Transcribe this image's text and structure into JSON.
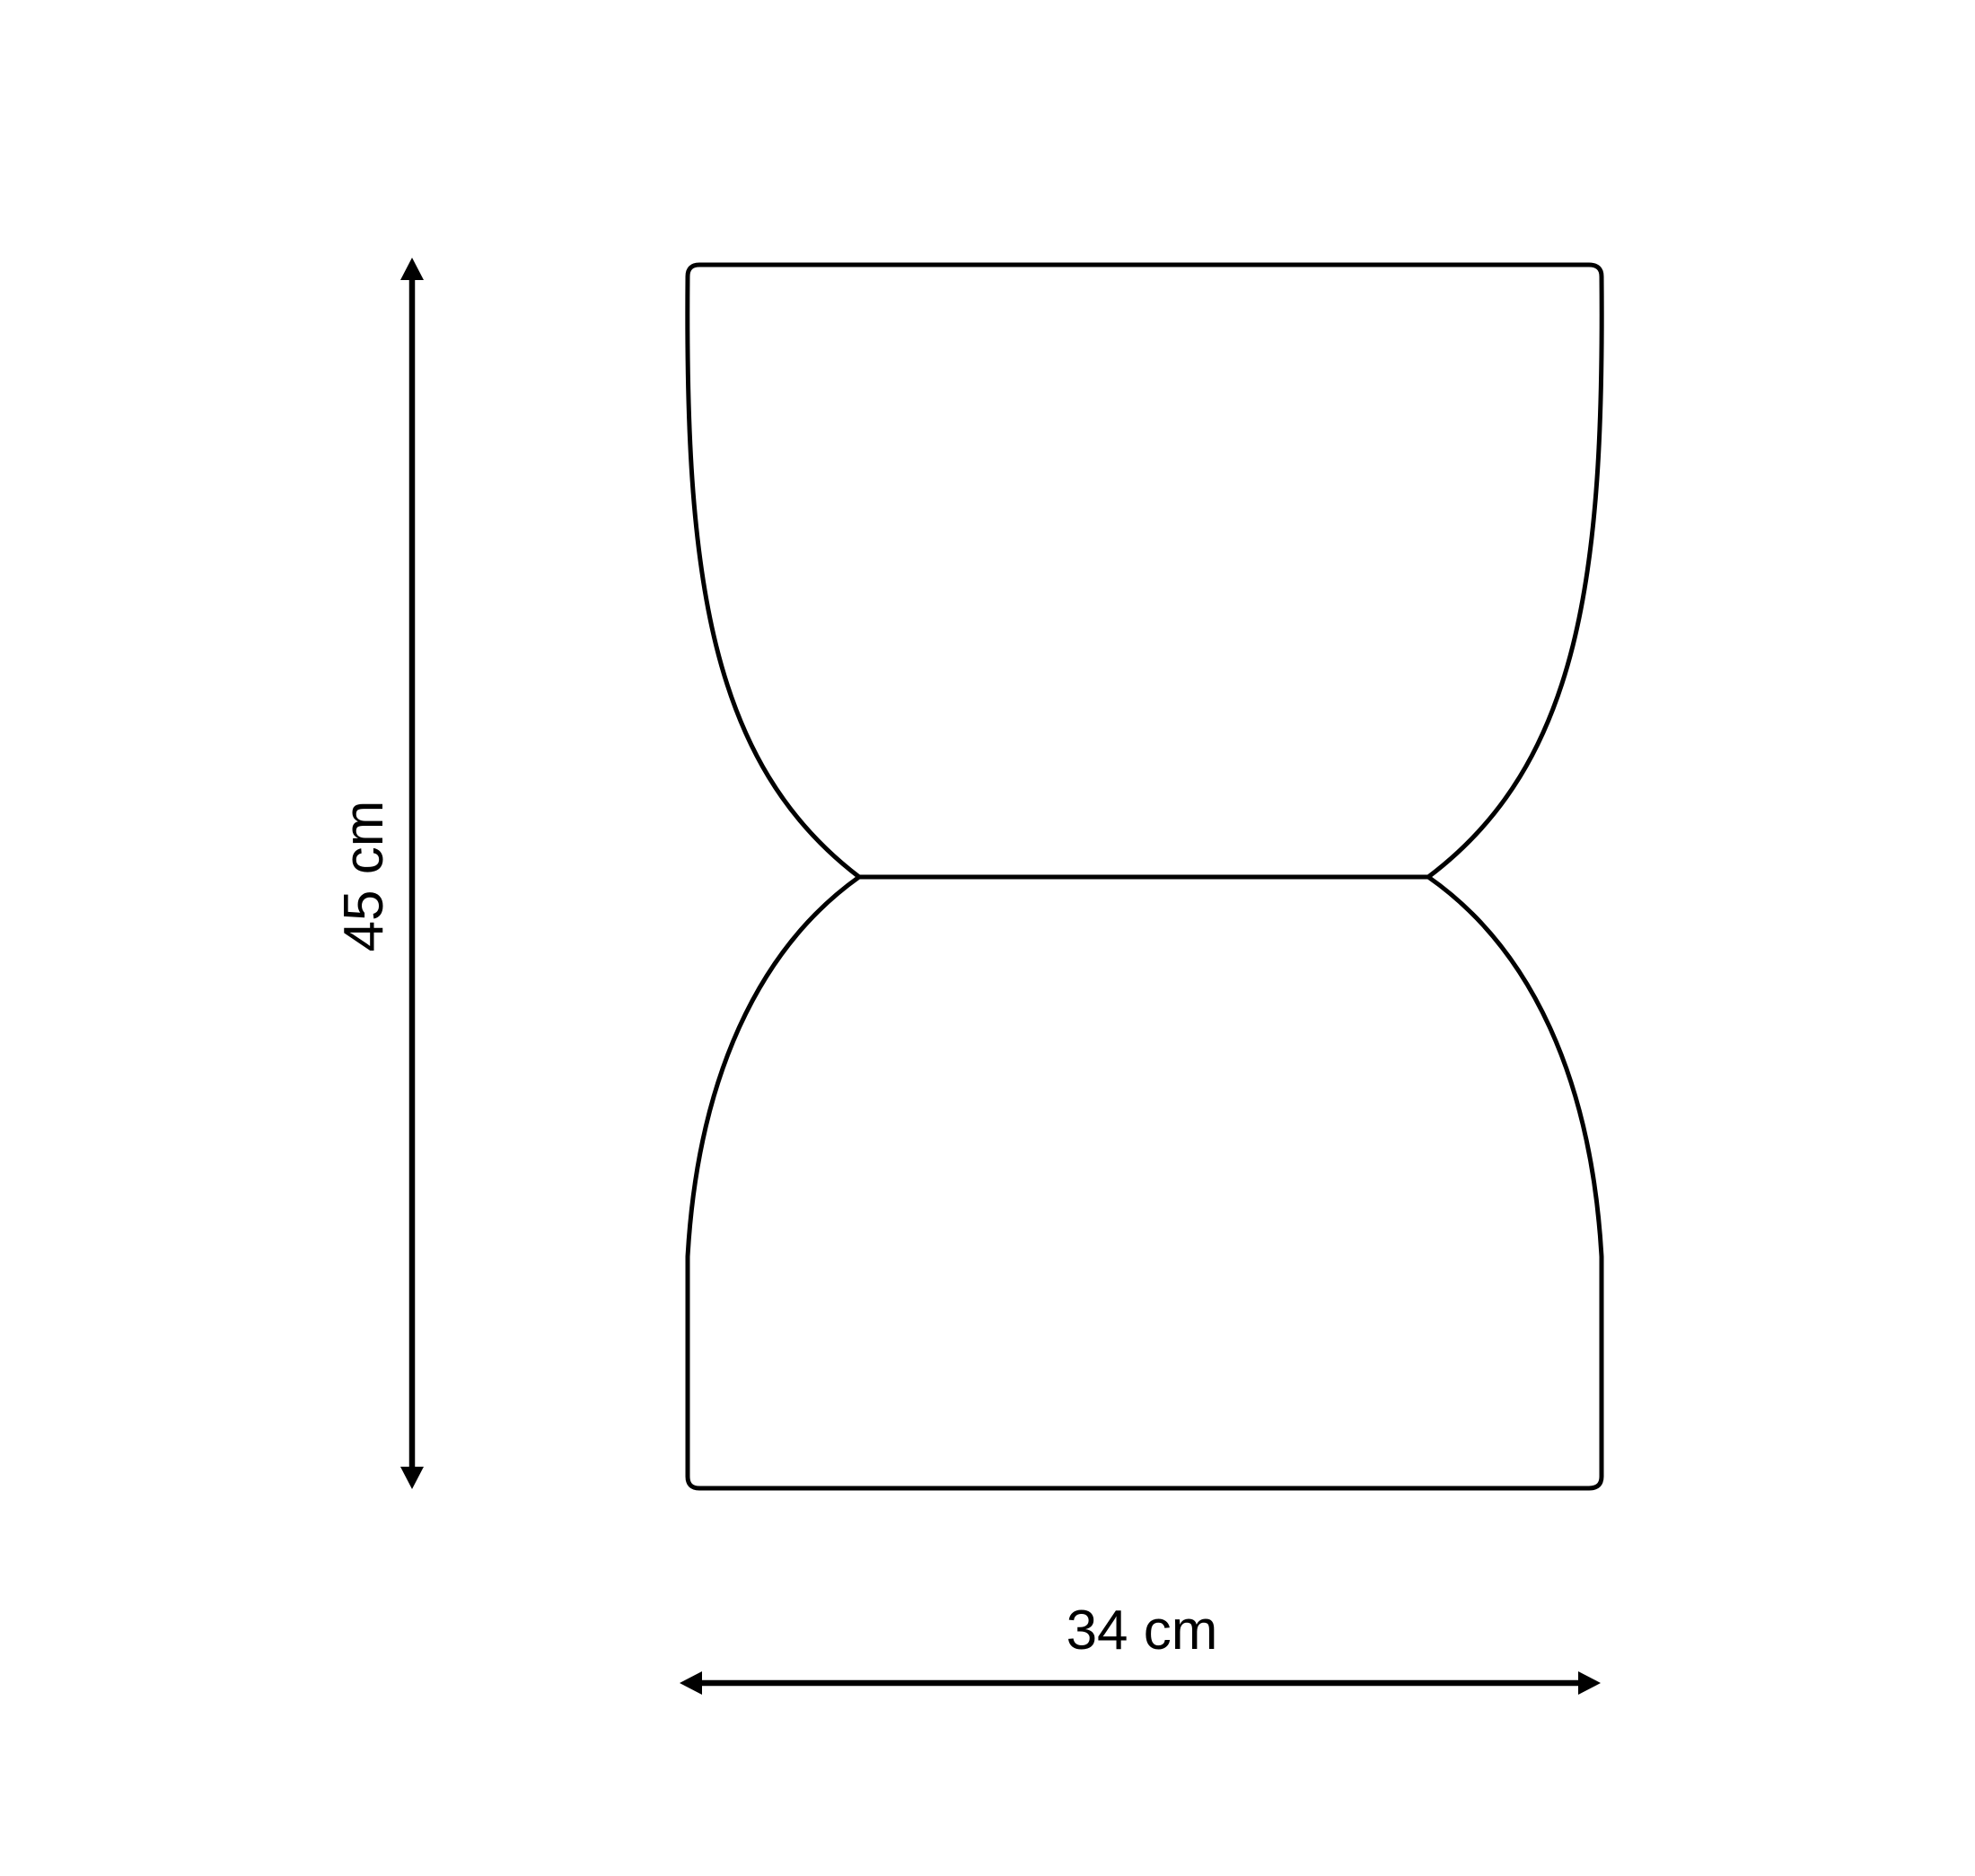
{
  "diagram": {
    "title": "Stool dimension drawing",
    "object": "hourglass-shaped stool silhouette",
    "dimensions": {
      "height_label": "45 cm",
      "width_label": "34 cm"
    },
    "colors": {
      "line": "#000000",
      "background": "#ffffff"
    }
  }
}
